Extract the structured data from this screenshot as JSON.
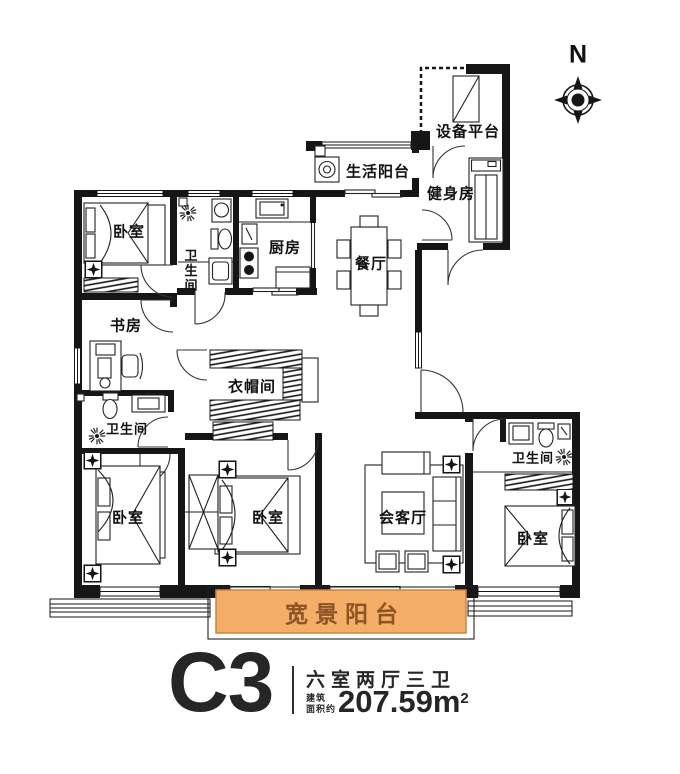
{
  "compass": {
    "north_label": "N"
  },
  "rooms": {
    "bedroom_top_left": "卧室",
    "bathroom_top": "卫生间",
    "kitchen": "厨房",
    "dining": "餐厅",
    "living_balcony": "生活阳台",
    "equipment_platform": "设备平台",
    "gym": "健身房",
    "study": "书房",
    "cloakroom": "衣帽间",
    "bathroom_mid": "卫生间",
    "bedroom_bottom_left": "卧室",
    "bedroom_bottom_mid": "卧室",
    "reception": "会客厅",
    "bathroom_right": "卫生间",
    "bedroom_bottom_right": "卧室",
    "panoramic_balcony": "宽景阳台"
  },
  "title": {
    "unit_code": "C3",
    "layout_desc": "六室两厅三卫",
    "area_prefix_line1": "建筑",
    "area_prefix_line2": "面积约",
    "area_value": "207.59m",
    "area_superscript": "2"
  },
  "colors": {
    "balcony_fill": "#f4ae68",
    "balcony_border": "#c8863f",
    "balcony_text": "#8c5526",
    "title_text": "#262626",
    "wall": "#161616"
  }
}
